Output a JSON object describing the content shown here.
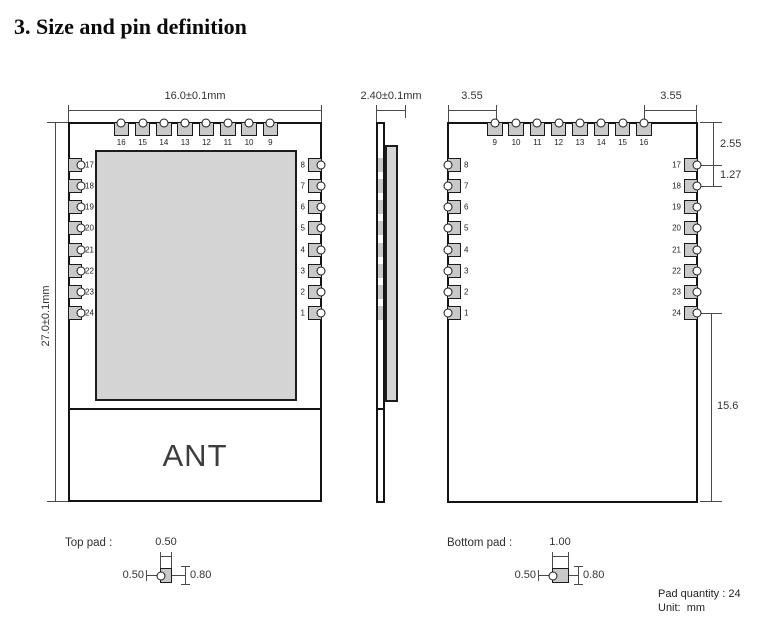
{
  "title": "3. Size and pin definition",
  "front_view": {
    "width_dim": "16.0±0.1mm",
    "height_dim": "27.0±0.1mm",
    "top_pins": [
      "16",
      "15",
      "14",
      "13",
      "12",
      "11",
      "10",
      "9"
    ],
    "left_pins": [
      "17",
      "18",
      "19",
      "20",
      "21",
      "22",
      "23",
      "24"
    ],
    "right_pins": [
      "8",
      "7",
      "6",
      "5",
      "4",
      "3",
      "2",
      "1"
    ],
    "ant_label": "ANT"
  },
  "side_view": {
    "thickness_dim": "2.40±0.1mm"
  },
  "back_view": {
    "left_offset_dim": "3.55",
    "right_offset_dim": "3.55",
    "top_pins": [
      "9",
      "10",
      "11",
      "12",
      "13",
      "14",
      "15",
      "16"
    ],
    "left_pins": [
      "8",
      "7",
      "6",
      "5",
      "4",
      "3",
      "2",
      "1"
    ],
    "right_pins": [
      "17",
      "18",
      "19",
      "20",
      "21",
      "22",
      "23",
      "24"
    ],
    "edge_to_pin_dim": "2.55",
    "pitch_dim": "1.27",
    "ant_area_dim": "15.6"
  },
  "top_pad": {
    "label": "Top pad :",
    "width": "0.50",
    "depth": "0.50",
    "height": "0.80"
  },
  "bottom_pad": {
    "label": "Bottom pad :",
    "width": "1.00",
    "depth": "0.50",
    "height": "0.80"
  },
  "footer": {
    "pad_quantity": "Pad quantity : 24",
    "unit": "Unit:  mm"
  },
  "colors": {
    "pad_fill": "#c9c9c9",
    "shield_fill": "#d4d4d4",
    "line": "#4a4a4a"
  }
}
